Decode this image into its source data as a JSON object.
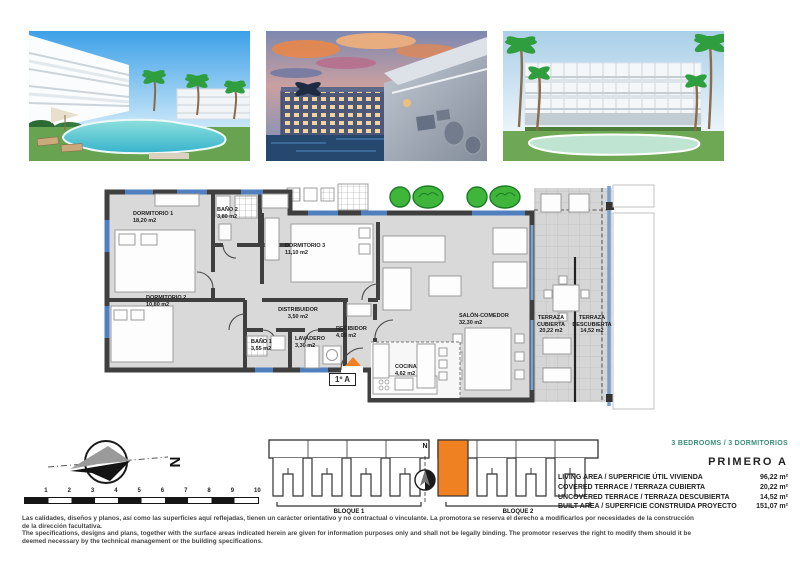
{
  "colors": {
    "accent_orange": "#ef8122",
    "wall_dark": "#3f3f3f",
    "room_fill": "#d9d9d9",
    "window_blue": "#4f7fbf",
    "glass_blue": "#7aa0cc",
    "tree_green": "#3fb53a",
    "heading_teal": "#3b8e79"
  },
  "floor_plan": {
    "unit_label": "1º A",
    "rooms": [
      {
        "name": "DORMITORIO 1",
        "area": "18,20 m2",
        "x": 133,
        "y": 211,
        "w": 58,
        "align": "left"
      },
      {
        "name": "BAÑO 2",
        "area": "3,80 m2",
        "x": 217,
        "y": 207,
        "w": 40,
        "align": "left"
      },
      {
        "name": "DORMITORIO 3",
        "area": "11,10 m2",
        "x": 285,
        "y": 243,
        "w": 58,
        "align": "left"
      },
      {
        "name": "DORMITORIO 2",
        "area": "10,80 m2",
        "x": 146,
        "y": 295,
        "w": 58,
        "align": "left"
      },
      {
        "name": "DISTRIBUIDOR",
        "area": "3,50 m2",
        "x": 272,
        "y": 307,
        "w": 52,
        "align": "center"
      },
      {
        "name": "BAÑO 1",
        "area": "3,55 m2",
        "x": 251,
        "y": 339,
        "w": 38,
        "align": "left"
      },
      {
        "name": "LAVADERO",
        "area": "3,30 m2",
        "x": 295,
        "y": 336,
        "w": 42,
        "align": "left"
      },
      {
        "name": "RECIBIDOR",
        "area": "4,05 m2",
        "x": 336,
        "y": 326,
        "w": 42,
        "align": "left"
      },
      {
        "name": "SALÓN-COMEDOR",
        "area": "32,30 m2",
        "x": 459,
        "y": 313,
        "w": 62,
        "align": "left"
      },
      {
        "name": "COCINA",
        "area": "4,62 m2",
        "x": 395,
        "y": 364,
        "w": 38,
        "align": "left"
      },
      {
        "name": "TERRAZA CUBIERTA",
        "area": "20,22 m2",
        "x": 534,
        "y": 315,
        "w": 34,
        "align": "center"
      },
      {
        "name": "TERRAZA DESCUBIERTA",
        "area": "14,52 m2",
        "x": 570,
        "y": 315,
        "w": 44,
        "align": "center"
      }
    ]
  },
  "site": {
    "north_label": "N",
    "scale_ticks": [
      "1",
      "2",
      "3",
      "4",
      "5",
      "6",
      "7",
      "8",
      "9",
      "10"
    ],
    "blocks": [
      {
        "label": "BLOQUE 1"
      },
      {
        "label": "BLOQUE 2"
      }
    ]
  },
  "summary": {
    "bedrooms": "3 BEDROOMS / 3 DORMITORIOS",
    "floor_unit": "PRIMERO  A",
    "rows": [
      {
        "label": "LIVING AREA / SUPERFICIE ÚTIL VIVIENDA",
        "value": "96,22 m²"
      },
      {
        "label": "COVERED TERRACE / TERRAZA CUBIERTA",
        "value": "20,22 m²"
      },
      {
        "label": "UNCOVERED TERRACE / TERRAZA DESCUBIERTA",
        "value": "14,52 m²"
      },
      {
        "label": "BUILT AREA / SUPERFICIE CONSTRUIDA PROYECTO",
        "value": "151,07 m²"
      }
    ]
  },
  "disclaimer": {
    "es": "Las calidades, diseños y planos, así como las superficies aquí reflejadas, tienen un carácter orientativo y no contractual o vinculante. La promotora se reserva el derecho a modificarlos por necesidades de la construcción de la dirección facultativa.",
    "en": "The specifications, designs and plans, together with the surface areas indicated herein are given for information purposes only and shall not be legally binding. The promotor reserves the right to modify them should it be deemed necessary by the technical management or the building specifications."
  }
}
